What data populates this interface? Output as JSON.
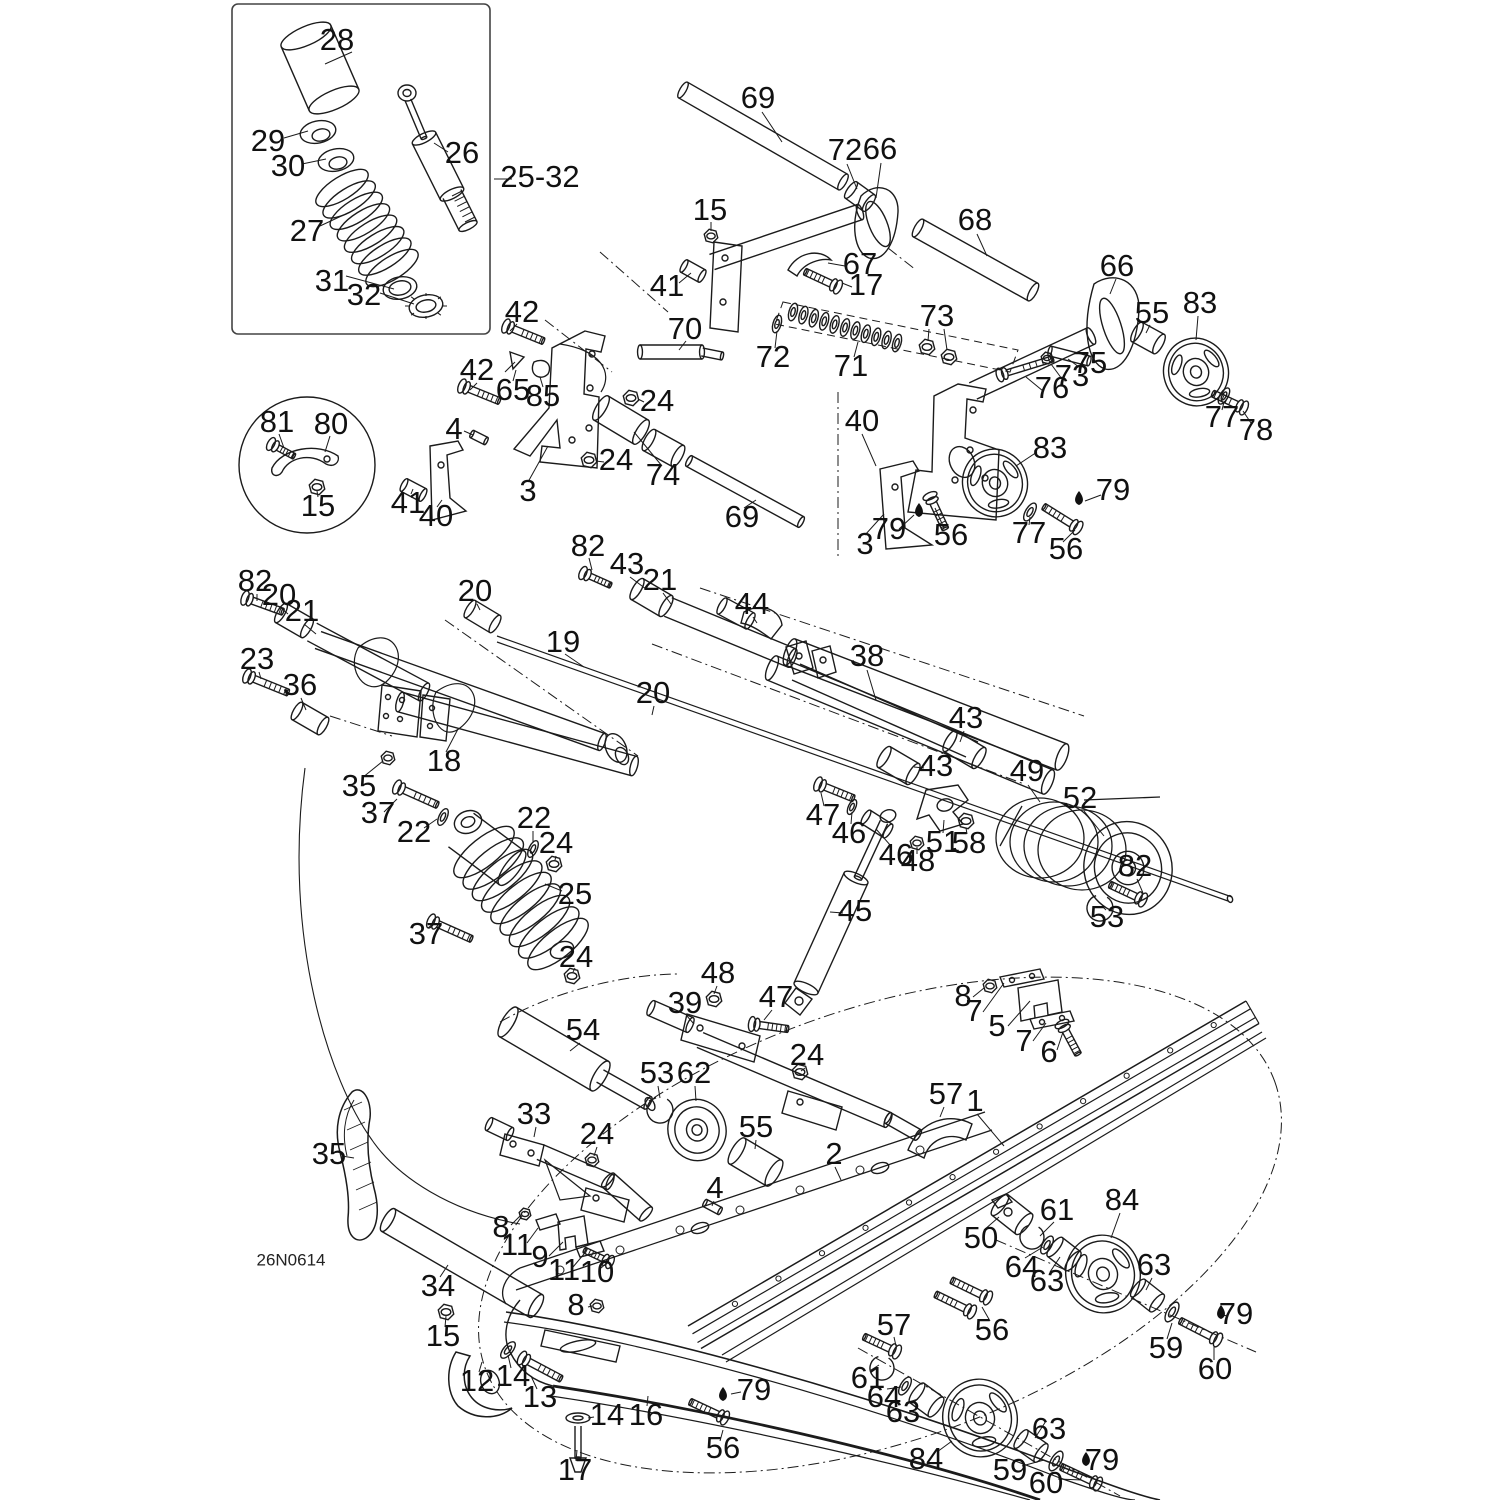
{
  "diagram_code": "26N0614",
  "colors": {
    "line": "#1b1b1b",
    "label": "#111111",
    "background": "#ffffff"
  },
  "callouts": [
    {
      "t": "28",
      "x": 337,
      "y": 42
    },
    {
      "t": "29",
      "x": 268,
      "y": 143
    },
    {
      "t": "30",
      "x": 288,
      "y": 168
    },
    {
      "t": "27",
      "x": 307,
      "y": 233
    },
    {
      "t": "31",
      "x": 332,
      "y": 283
    },
    {
      "t": "32",
      "x": 364,
      "y": 297
    },
    {
      "t": "26",
      "x": 462,
      "y": 155
    },
    {
      "t": "25-32",
      "x": 540,
      "y": 179
    },
    {
      "t": "81",
      "x": 277,
      "y": 424
    },
    {
      "t": "80",
      "x": 331,
      "y": 426
    },
    {
      "t": "15",
      "x": 318,
      "y": 508
    },
    {
      "t": "69",
      "x": 758,
      "y": 100
    },
    {
      "t": "72",
      "x": 845,
      "y": 152
    },
    {
      "t": "66",
      "x": 880,
      "y": 151
    },
    {
      "t": "15",
      "x": 710,
      "y": 212
    },
    {
      "t": "68",
      "x": 975,
      "y": 222
    },
    {
      "t": "67",
      "x": 860,
      "y": 266
    },
    {
      "t": "17",
      "x": 866,
      "y": 287
    },
    {
      "t": "41",
      "x": 667,
      "y": 288
    },
    {
      "t": "70",
      "x": 685,
      "y": 331
    },
    {
      "t": "72",
      "x": 773,
      "y": 359
    },
    {
      "t": "71",
      "x": 851,
      "y": 368
    },
    {
      "t": "73",
      "x": 937,
      "y": 318
    },
    {
      "t": "66",
      "x": 1117,
      "y": 268
    },
    {
      "t": "55",
      "x": 1152,
      "y": 315
    },
    {
      "t": "83",
      "x": 1200,
      "y": 305
    },
    {
      "t": "75",
      "x": 1090,
      "y": 365
    },
    {
      "t": "73",
      "x": 1072,
      "y": 378
    },
    {
      "t": "76",
      "x": 1052,
      "y": 390
    },
    {
      "t": "77",
      "x": 1222,
      "y": 419
    },
    {
      "t": "78",
      "x": 1256,
      "y": 432
    },
    {
      "t": "42",
      "x": 522,
      "y": 314
    },
    {
      "t": "42",
      "x": 477,
      "y": 372
    },
    {
      "t": "65",
      "x": 513,
      "y": 392
    },
    {
      "t": "85",
      "x": 543,
      "y": 398
    },
    {
      "t": "24",
      "x": 657,
      "y": 403
    },
    {
      "t": "4",
      "x": 454,
      "y": 431
    },
    {
      "t": "24",
      "x": 616,
      "y": 462
    },
    {
      "t": "74",
      "x": 663,
      "y": 477
    },
    {
      "t": "69",
      "x": 742,
      "y": 519
    },
    {
      "t": "3",
      "x": 528,
      "y": 493
    },
    {
      "t": "41",
      "x": 408,
      "y": 505
    },
    {
      "t": "40",
      "x": 436,
      "y": 518
    },
    {
      "t": "40",
      "x": 862,
      "y": 423
    },
    {
      "t": "83",
      "x": 1050,
      "y": 450
    },
    {
      "t": "79",
      "x": 889,
      "y": 531
    },
    {
      "t": "56",
      "x": 951,
      "y": 537
    },
    {
      "t": "3",
      "x": 865,
      "y": 546
    },
    {
      "t": "77",
      "x": 1029,
      "y": 535
    },
    {
      "t": "56",
      "x": 1066,
      "y": 551
    },
    {
      "t": "79",
      "x": 1113,
      "y": 492
    },
    {
      "t": "82",
      "x": 588,
      "y": 548
    },
    {
      "t": "43",
      "x": 627,
      "y": 566
    },
    {
      "t": "21",
      "x": 660,
      "y": 582
    },
    {
      "t": "44",
      "x": 752,
      "y": 606
    },
    {
      "t": "38",
      "x": 867,
      "y": 658
    },
    {
      "t": "19",
      "x": 563,
      "y": 644
    },
    {
      "t": "20",
      "x": 653,
      "y": 695
    },
    {
      "t": "43",
      "x": 966,
      "y": 720
    },
    {
      "t": "43",
      "x": 936,
      "y": 768
    },
    {
      "t": "49",
      "x": 1027,
      "y": 773
    },
    {
      "t": "52",
      "x": 1080,
      "y": 800
    },
    {
      "t": "47",
      "x": 823,
      "y": 817
    },
    {
      "t": "46",
      "x": 849,
      "y": 835
    },
    {
      "t": "46",
      "x": 896,
      "y": 857
    },
    {
      "t": "48",
      "x": 918,
      "y": 863
    },
    {
      "t": "51",
      "x": 943,
      "y": 844
    },
    {
      "t": "58",
      "x": 969,
      "y": 845
    },
    {
      "t": "82",
      "x": 1135,
      "y": 868
    },
    {
      "t": "53",
      "x": 1107,
      "y": 919
    },
    {
      "t": "45",
      "x": 855,
      "y": 913
    },
    {
      "t": "82",
      "x": 255,
      "y": 583
    },
    {
      "t": "20",
      "x": 279,
      "y": 597
    },
    {
      "t": "21",
      "x": 302,
      "y": 613
    },
    {
      "t": "23",
      "x": 257,
      "y": 661
    },
    {
      "t": "36",
      "x": 300,
      "y": 687
    },
    {
      "t": "20",
      "x": 475,
      "y": 593
    },
    {
      "t": "18",
      "x": 444,
      "y": 763
    },
    {
      "t": "35",
      "x": 359,
      "y": 788
    },
    {
      "t": "37",
      "x": 378,
      "y": 815
    },
    {
      "t": "22",
      "x": 414,
      "y": 834
    },
    {
      "t": "22",
      "x": 534,
      "y": 820
    },
    {
      "t": "24",
      "x": 556,
      "y": 845
    },
    {
      "t": "25",
      "x": 575,
      "y": 896
    },
    {
      "t": "37",
      "x": 426,
      "y": 936
    },
    {
      "t": "24",
      "x": 576,
      "y": 959
    },
    {
      "t": "48",
      "x": 718,
      "y": 975
    },
    {
      "t": "39",
      "x": 685,
      "y": 1005
    },
    {
      "t": "47",
      "x": 776,
      "y": 999
    },
    {
      "t": "54",
      "x": 583,
      "y": 1032
    },
    {
      "t": "24",
      "x": 807,
      "y": 1057
    },
    {
      "t": "53",
      "x": 657,
      "y": 1075
    },
    {
      "t": "62",
      "x": 694,
      "y": 1075
    },
    {
      "t": "55",
      "x": 756,
      "y": 1129
    },
    {
      "t": "2",
      "x": 834,
      "y": 1156
    },
    {
      "t": "4",
      "x": 715,
      "y": 1190
    },
    {
      "t": "57",
      "x": 946,
      "y": 1096
    },
    {
      "t": "1",
      "x": 975,
      "y": 1103
    },
    {
      "t": "8",
      "x": 963,
      "y": 998
    },
    {
      "t": "7",
      "x": 974,
      "y": 1013
    },
    {
      "t": "5",
      "x": 997,
      "y": 1028
    },
    {
      "t": "7",
      "x": 1024,
      "y": 1043
    },
    {
      "t": "6",
      "x": 1049,
      "y": 1054
    },
    {
      "t": "24",
      "x": 597,
      "y": 1136
    },
    {
      "t": "33",
      "x": 534,
      "y": 1116
    },
    {
      "t": "35",
      "x": 329,
      "y": 1156
    },
    {
      "t": "34",
      "x": 438,
      "y": 1288
    },
    {
      "t": "15",
      "x": 443,
      "y": 1338
    },
    {
      "t": "12",
      "x": 477,
      "y": 1383
    },
    {
      "t": "14",
      "x": 513,
      "y": 1378
    },
    {
      "t": "13",
      "x": 540,
      "y": 1399
    },
    {
      "t": "8",
      "x": 501,
      "y": 1229
    },
    {
      "t": "11",
      "x": 517,
      "y": 1247
    },
    {
      "t": "9",
      "x": 540,
      "y": 1259
    },
    {
      "t": "11",
      "x": 564,
      "y": 1272
    },
    {
      "t": "10",
      "x": 597,
      "y": 1274
    },
    {
      "t": "8",
      "x": 576,
      "y": 1307
    },
    {
      "t": "14",
      "x": 607,
      "y": 1417
    },
    {
      "t": "16",
      "x": 646,
      "y": 1417
    },
    {
      "t": "17",
      "x": 575,
      "y": 1472
    },
    {
      "t": "79",
      "x": 754,
      "y": 1392
    },
    {
      "t": "56",
      "x": 723,
      "y": 1450
    },
    {
      "t": "50",
      "x": 981,
      "y": 1240
    },
    {
      "t": "61",
      "x": 1057,
      "y": 1212
    },
    {
      "t": "84",
      "x": 1122,
      "y": 1202
    },
    {
      "t": "64",
      "x": 1022,
      "y": 1269
    },
    {
      "t": "63",
      "x": 1047,
      "y": 1283
    },
    {
      "t": "63",
      "x": 1154,
      "y": 1267
    },
    {
      "t": "59",
      "x": 1166,
      "y": 1350
    },
    {
      "t": "60",
      "x": 1215,
      "y": 1371
    },
    {
      "t": "79",
      "x": 1236,
      "y": 1316
    },
    {
      "t": "56",
      "x": 992,
      "y": 1332
    },
    {
      "t": "57",
      "x": 894,
      "y": 1327
    },
    {
      "t": "61",
      "x": 868,
      "y": 1380
    },
    {
      "t": "64",
      "x": 884,
      "y": 1399
    },
    {
      "t": "63",
      "x": 903,
      "y": 1414
    },
    {
      "t": "84",
      "x": 926,
      "y": 1461
    },
    {
      "t": "63",
      "x": 1049,
      "y": 1431
    },
    {
      "t": "59",
      "x": 1010,
      "y": 1472
    },
    {
      "t": "60",
      "x": 1046,
      "y": 1485
    },
    {
      "t": "79",
      "x": 1102,
      "y": 1462
    }
  ],
  "oil_drops": [
    {
      "x": 919,
      "y": 512
    },
    {
      "x": 1079,
      "y": 500
    },
    {
      "x": 723,
      "y": 1396
    },
    {
      "x": 1221,
      "y": 1314
    },
    {
      "x": 1086,
      "y": 1461
    }
  ]
}
